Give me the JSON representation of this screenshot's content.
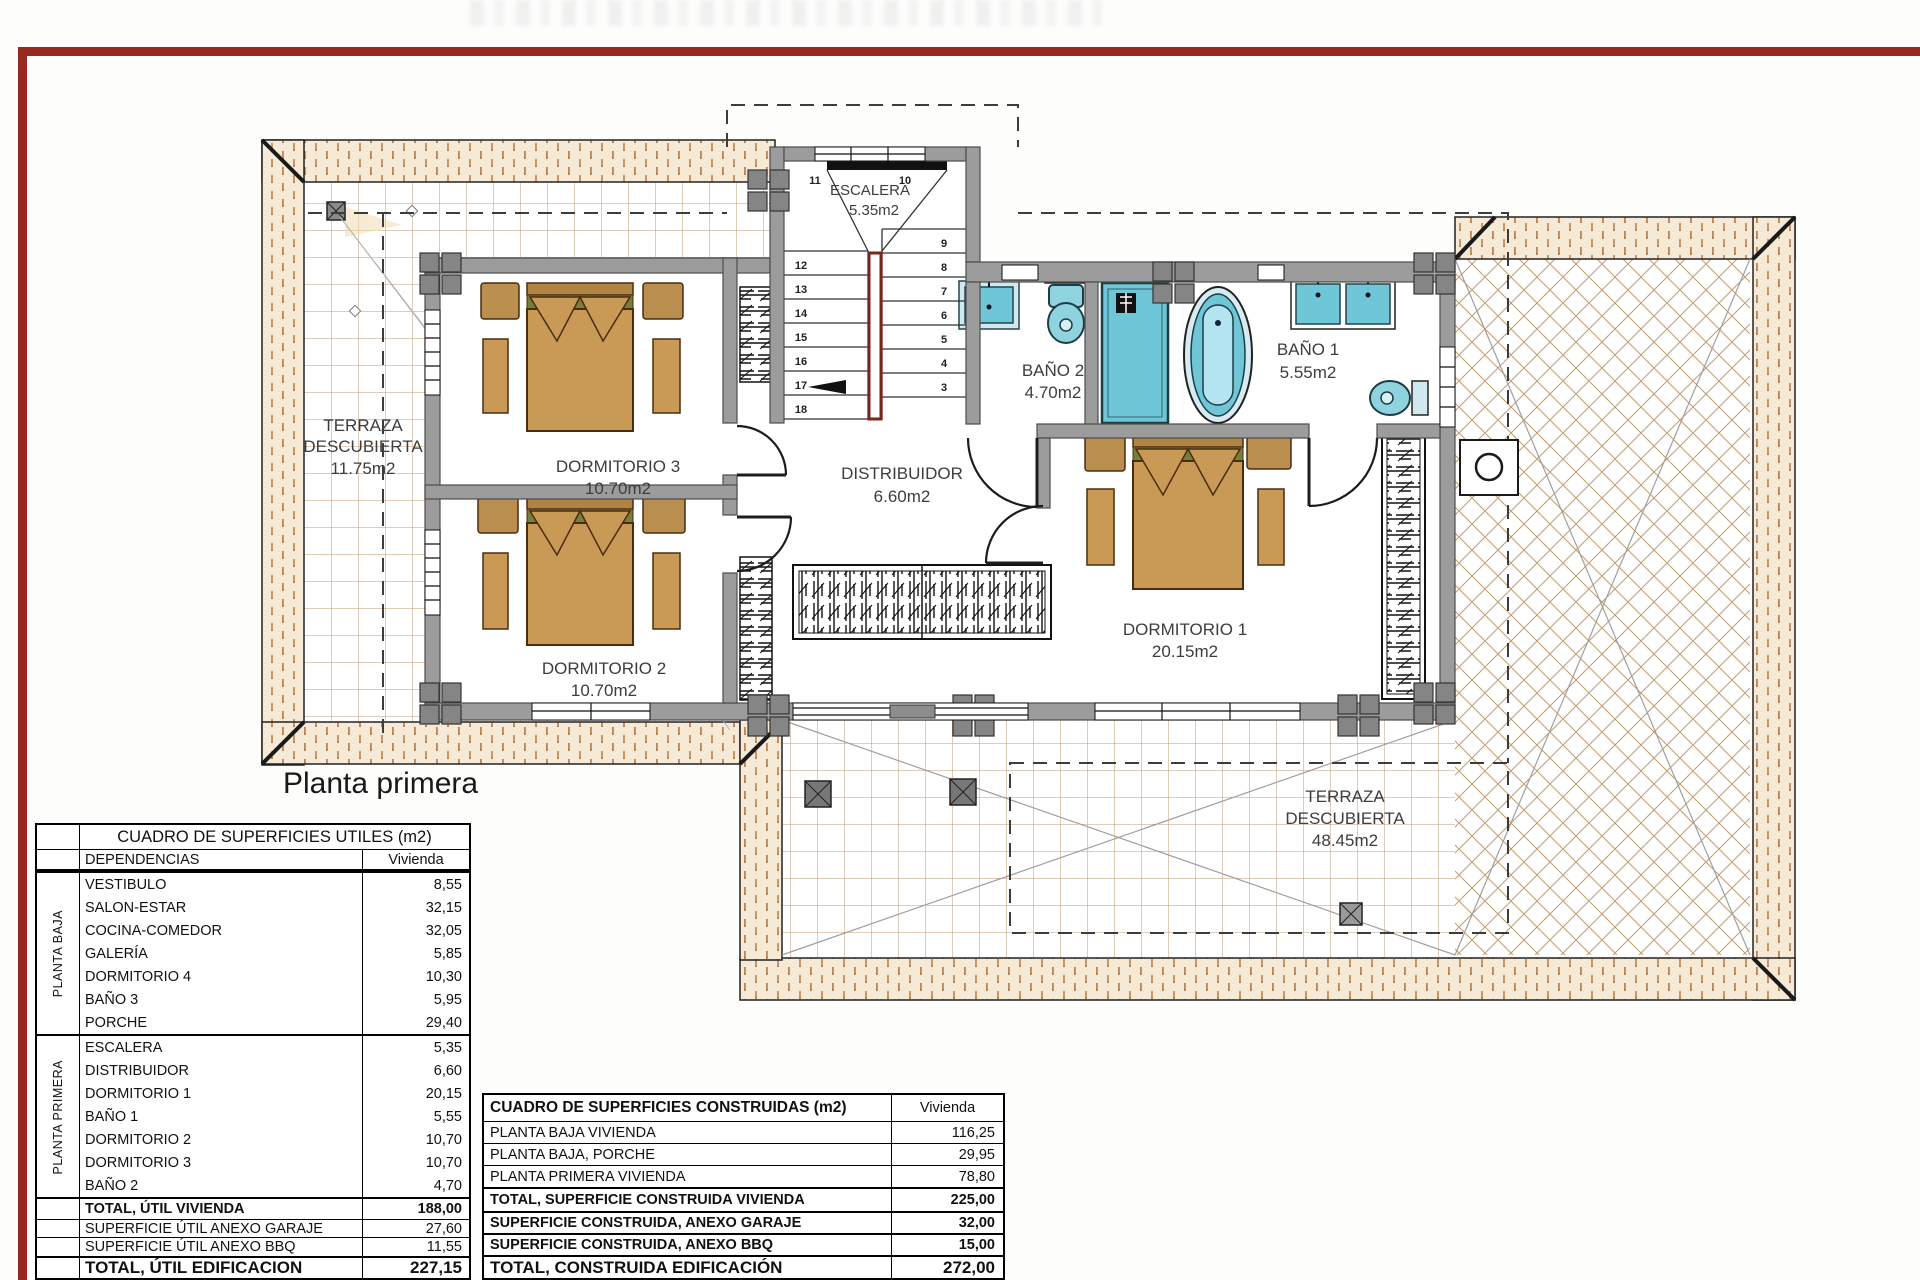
{
  "page": {
    "plan_title": "Planta primera"
  },
  "colors": {
    "accent_red": "#97291f",
    "wall_gray": "#9c9c9c",
    "fixture_teal": "#6fc6d6",
    "wood_tan": "#c99a55",
    "tile_line": "#c39b6e",
    "stair_rail_red": "#7b241b"
  },
  "plan": {
    "rooms": {
      "terraza_left": {
        "line1": "TERRAZA",
        "line2": "DESCUBIERTA",
        "area": "11.75m2"
      },
      "escalera": {
        "name": "ESCALERA",
        "area": "5.35m2"
      },
      "dormitorio3": {
        "name": "DORMITORIO 3",
        "area": "10.70m2"
      },
      "dormitorio2": {
        "name": "DORMITORIO 2",
        "area": "10.70m2"
      },
      "distribuidor": {
        "name": "DISTRIBUIDOR",
        "area": "6.60m2"
      },
      "bano2": {
        "name": "BAÑO 2",
        "area": "4.70m2"
      },
      "bano1": {
        "name": "BAÑO 1",
        "area": "5.55m2"
      },
      "dormitorio1": {
        "name": "DORMITORIO 1",
        "area": "20.15m2"
      },
      "terraza_bottom": {
        "line1": "TERRAZA",
        "line2": "DESCUBIERTA",
        "area": "48.45m2"
      }
    },
    "stair": {
      "top_numbers": [
        "11",
        "10"
      ],
      "left_numbers": [
        "12",
        "13",
        "14",
        "15",
        "16",
        "17",
        "18"
      ],
      "right_numbers": [
        "9",
        "8",
        "7",
        "6",
        "5",
        "4",
        "3"
      ]
    }
  },
  "left_table": {
    "title": "CUADRO DE SUPERFICIES UTILES (m2)",
    "col_dependencias": "DEPENDENCIAS",
    "col_value": "Vivienda",
    "groups": [
      {
        "label": "PLANTA BAJA",
        "rows": [
          {
            "name": "VESTIBULO",
            "value": "8,55"
          },
          {
            "name": "SALON-ESTAR",
            "value": "32,15"
          },
          {
            "name": "COCINA-COMEDOR",
            "value": "32,05"
          },
          {
            "name": "GALERÍA",
            "value": "5,85"
          },
          {
            "name": "DORMITORIO 4",
            "value": "10,30"
          },
          {
            "name": "BAÑO 3",
            "value": "5,95"
          },
          {
            "name": "PORCHE",
            "value": "29,40"
          }
        ]
      },
      {
        "label": "PLANTA PRIMERA",
        "rows": [
          {
            "name": "ESCALERA",
            "value": "5,35"
          },
          {
            "name": "DISTRIBUIDOR",
            "value": "6,60"
          },
          {
            "name": "DORMITORIO 1",
            "value": "20,15"
          },
          {
            "name": "BAÑO 1",
            "value": "5,55"
          },
          {
            "name": "DORMITORIO 2",
            "value": "10,70"
          },
          {
            "name": "DORMITORIO 3",
            "value": "10,70"
          },
          {
            "name": "BAÑO 2",
            "value": "4,70"
          }
        ]
      }
    ],
    "totals": [
      {
        "name": "TOTAL, ÚTIL VIVIENDA",
        "value": "188,00"
      },
      {
        "name": "SUPERFICIE ÚTIL ANEXO GARAJE",
        "value": "27,60"
      },
      {
        "name": "SUPERFICIE ÚTIL ANEXO BBQ",
        "value": "11,55"
      },
      {
        "name": "TOTAL, ÚTIL EDIFICACION",
        "value": "227,15"
      }
    ]
  },
  "right_table": {
    "title": "CUADRO DE SUPERFICIES CONSTRUIDAS (m2)",
    "col_value": "Vivienda",
    "rows": [
      {
        "name": "PLANTA BAJA VIVIENDA",
        "value": "116,25"
      },
      {
        "name": "PLANTA BAJA, PORCHE",
        "value": "29,95"
      },
      {
        "name": "PLANTA PRIMERA VIVIENDA",
        "value": "78,80"
      }
    ],
    "totals": [
      {
        "name": "TOTAL, SUPERFICIE CONSTRUIDA VIVIENDA",
        "value": "225,00"
      },
      {
        "name": "SUPERFICIE CONSTRUIDA, ANEXO GARAJE",
        "value": "32,00"
      },
      {
        "name": "SUPERFICIE CONSTRUIDA, ANEXO BBQ",
        "value": "15,00"
      },
      {
        "name": "TOTAL, CONSTRUIDA EDIFICACIÓN",
        "value": "272,00"
      }
    ]
  }
}
